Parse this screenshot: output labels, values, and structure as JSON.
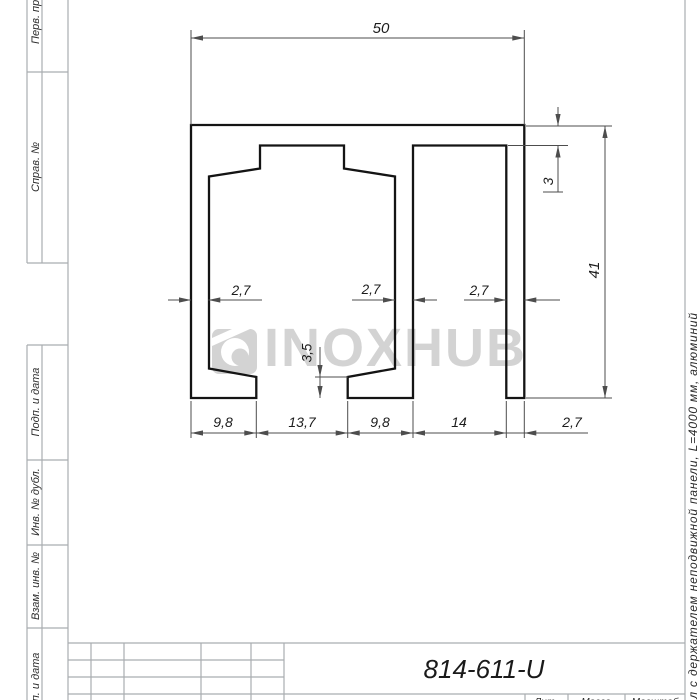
{
  "sheet": {
    "type": "GOST engineering drawing sheet"
  },
  "sidebar": {
    "labels": [
      "Перв. примен.",
      "Справ. №",
      "Подп. и дата",
      "Инв. № дубл.",
      "Взам. инв. №",
      "Подп. и дата"
    ]
  },
  "dimensions": {
    "width_top": "50",
    "wall_thickness_top": "3",
    "height_right": "41",
    "wall_left": "2,7",
    "wall_middle": "2,7",
    "wall_right": "2,7",
    "step_height": "3,5",
    "bottom_chain": [
      "9,8",
      "13,7",
      "9,8",
      "14",
      "2,7"
    ]
  },
  "watermark": {
    "brand": "INOXHUB"
  },
  "title_block": {
    "designation": "814-611-U",
    "literature_label": "Лит.",
    "mass_label": "Масса",
    "scale_label": "Масштаб"
  },
  "margin_note": {
    "text": "ал с держателем неподвижной панели, L=4000 мм, алюминий"
  },
  "colors": {
    "outline": "#141414",
    "dimension": "#4d4d4d",
    "frame": "#a9adb0",
    "watermark": "#d3d3d3",
    "text": "#1c1c1c"
  }
}
